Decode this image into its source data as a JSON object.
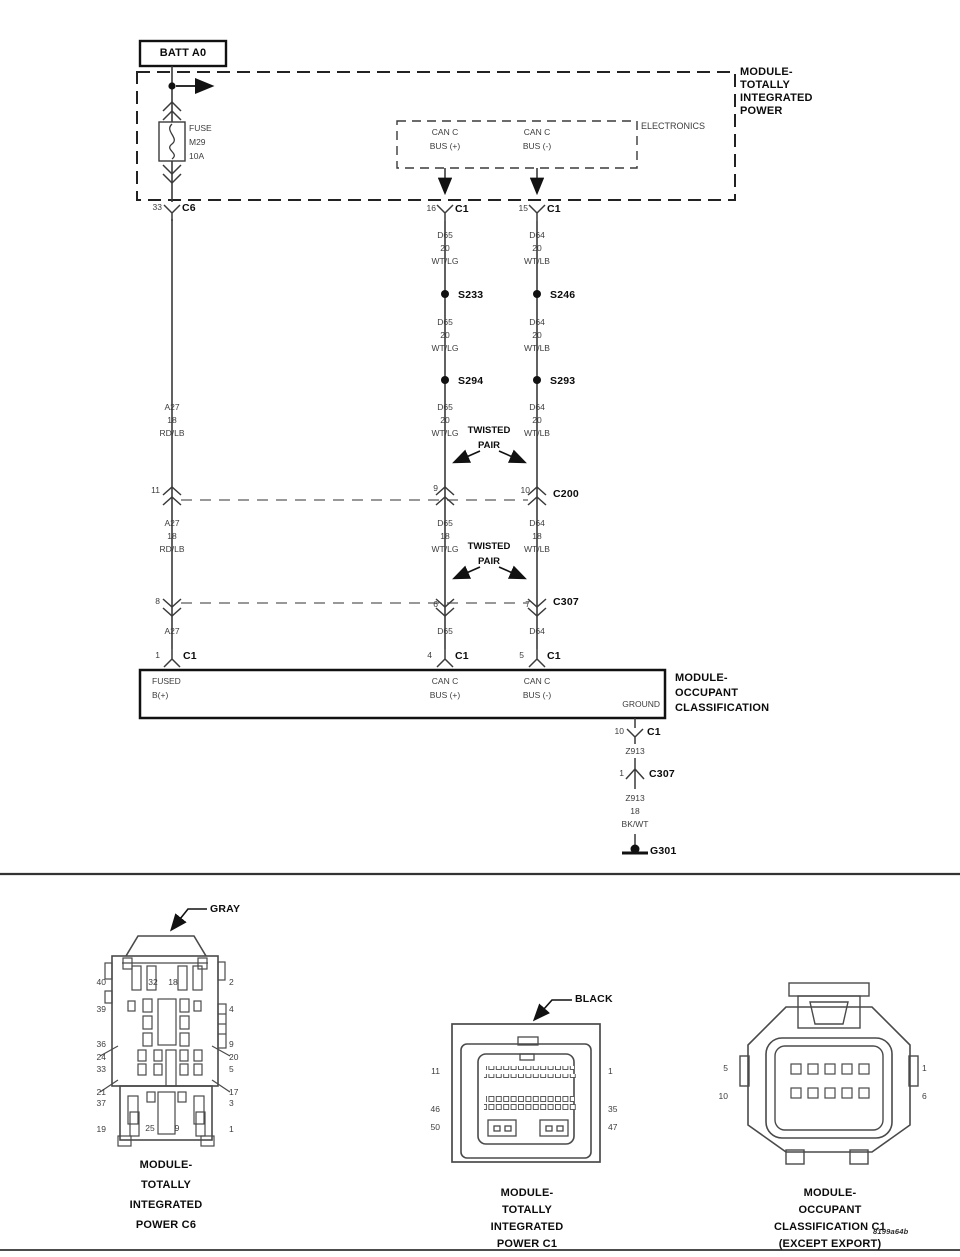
{
  "schematic": {
    "batt_box": "BATT A0",
    "tipm_label": [
      "MODULE-",
      "TOTALLY",
      "INTEGRATED",
      "POWER"
    ],
    "electronics_label": "ELECTRONICS",
    "can_bus_plus": [
      "CAN C",
      "BUS (+)"
    ],
    "can_bus_minus": [
      "CAN C",
      "BUS (-)"
    ],
    "fuse_label": [
      "FUSE",
      "M29",
      "10A"
    ],
    "conn_c6": "C6",
    "conn_c1": "C1",
    "conn_c200": "C200",
    "conn_c307": "C307",
    "ground_g301": "G301",
    "pin_33": "33",
    "pin_16": "16",
    "pin_15": "15",
    "pin_11": "11",
    "pin_9": "9",
    "pin_10": "10",
    "pin_8": "8",
    "pin_6": "6",
    "pin_7": "7",
    "pin_1": "1",
    "pin_4": "4",
    "pin_5": "5",
    "gnd_pin_10": "10",
    "gnd_pin_1": "1",
    "wire_d65_20": [
      "D65",
      "20",
      "WT/LG"
    ],
    "wire_d64_20": [
      "D64",
      "20",
      "WT/LB"
    ],
    "wire_d65_18": [
      "D65",
      "18",
      "WT/LG"
    ],
    "wire_d64_18": [
      "D64",
      "18",
      "WT/LB"
    ],
    "wire_a27_18": [
      "A27",
      "18",
      "RD/LB"
    ],
    "wire_a27": "A27",
    "wire_d65": "D65",
    "wire_d64": "D64",
    "wire_z913": "Z913",
    "wire_z913_18": [
      "Z913",
      "18",
      "BK/WT"
    ],
    "splice_s233": "S233",
    "splice_s246": "S246",
    "splice_s294": "S294",
    "splice_s293": "S293",
    "twisted_pair": [
      "TWISTED",
      "PAIR"
    ],
    "ocm_label": [
      "MODULE-",
      "OCCUPANT",
      "CLASSIFICATION"
    ],
    "ocm_ports": {
      "fused": [
        "FUSED",
        "B(+)"
      ],
      "ground": "GROUND"
    }
  },
  "pinouts": {
    "tipm_c6": {
      "color": "GRAY",
      "caption": [
        "MODULE-",
        "TOTALLY",
        "INTEGRATED",
        "POWER C6"
      ],
      "left_pins": [
        "40",
        "39",
        "36",
        "24",
        "33",
        "21",
        "37",
        "19"
      ],
      "right_pins": [
        "2",
        "4",
        "9",
        "20",
        "5",
        "17",
        "3",
        "1"
      ],
      "inner_top_pins": [
        "32",
        "18"
      ],
      "inner_bottom_pins": [
        "25",
        "9"
      ]
    },
    "tipm_c1": {
      "color": "BLACK",
      "caption": [
        "MODULE-",
        "TOTALLY",
        "INTEGRATED",
        "POWER C1"
      ],
      "left_pins": [
        "11",
        "46",
        "50"
      ],
      "right_pins": [
        "1",
        "35",
        "47"
      ]
    },
    "ocm_c1": {
      "caption": [
        "MODULE-",
        "OCCUPANT",
        "CLASSIFICATION C1",
        "(EXCEPT EXPORT)"
      ],
      "left_pins": [
        "5",
        "10"
      ],
      "right_pins": [
        "1",
        "6"
      ]
    }
  },
  "footer": {
    "code": "8199a64b"
  }
}
